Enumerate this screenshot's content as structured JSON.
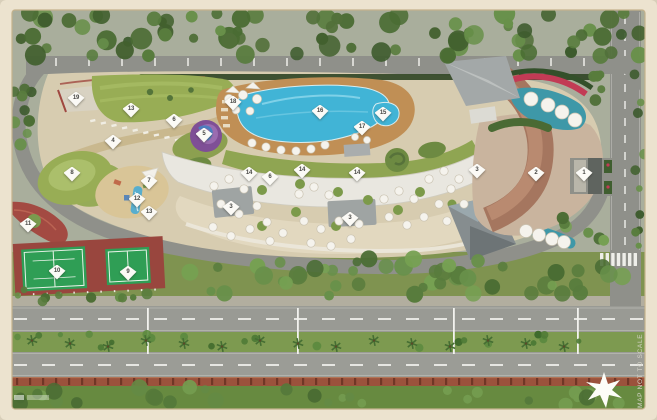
{
  "map": {
    "note": "MAP NOT TO SCALE"
  },
  "markers": [
    {
      "n": "1",
      "x": 584,
      "y": 174
    },
    {
      "n": "2",
      "x": 536,
      "y": 174
    },
    {
      "n": "3",
      "x": 231,
      "y": 208
    },
    {
      "n": "3",
      "x": 350,
      "y": 219
    },
    {
      "n": "3",
      "x": 477,
      "y": 171
    },
    {
      "n": "4",
      "x": 113,
      "y": 142
    },
    {
      "n": "5",
      "x": 204,
      "y": 135
    },
    {
      "n": "6",
      "x": 174,
      "y": 121
    },
    {
      "n": "6",
      "x": 270,
      "y": 178
    },
    {
      "n": "7",
      "x": 149,
      "y": 182
    },
    {
      "n": "8",
      "x": 72,
      "y": 174
    },
    {
      "n": "9",
      "x": 128,
      "y": 273
    },
    {
      "n": "10",
      "x": 57,
      "y": 272
    },
    {
      "n": "11",
      "x": 28,
      "y": 225
    },
    {
      "n": "12",
      "x": 137,
      "y": 200
    },
    {
      "n": "13",
      "x": 131,
      "y": 110
    },
    {
      "n": "13",
      "x": 149,
      "y": 213
    },
    {
      "n": "14",
      "x": 249,
      "y": 174
    },
    {
      "n": "14",
      "x": 302,
      "y": 171
    },
    {
      "n": "14",
      "x": 357,
      "y": 174
    },
    {
      "n": "15",
      "x": 383,
      "y": 114
    },
    {
      "n": "16",
      "x": 320,
      "y": 112
    },
    {
      "n": "17",
      "x": 362,
      "y": 128
    },
    {
      "n": "18",
      "x": 233,
      "y": 103
    },
    {
      "n": "19",
      "x": 76,
      "y": 99
    }
  ],
  "colors": {
    "frame": "#ece3cf",
    "forest": "#54743a",
    "road": "#8f908a",
    "site": "#d7ccb0",
    "lawn": "#98ad55",
    "pool": "#41b4d6",
    "deck": "#c08f55",
    "court": "#2f9e55",
    "courtbase": "#99463e",
    "median": "#7d9a50",
    "building": "#e9e7e0",
    "teal": "#3e98a8",
    "flower": "#c23b55",
    "marker": "#fbfaf6"
  }
}
